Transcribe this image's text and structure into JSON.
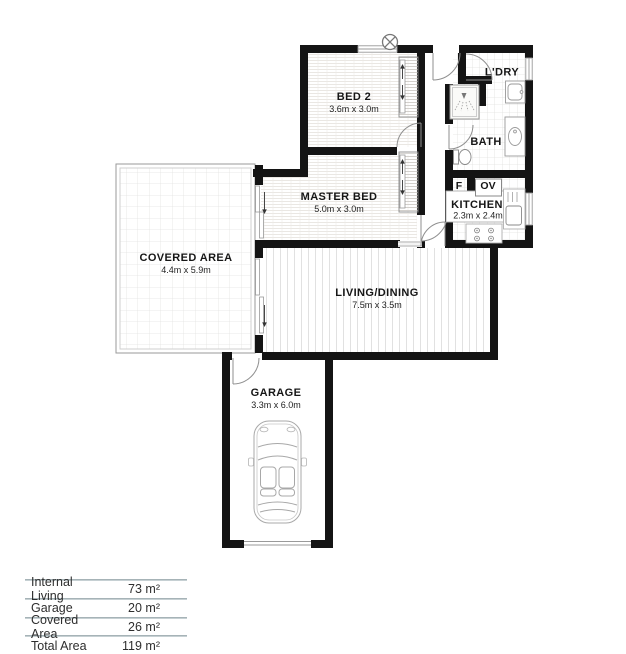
{
  "plan": {
    "rooms": {
      "bed2": {
        "name": "BED 2",
        "dims": "3.6m x 3.0m"
      },
      "master": {
        "name": "MASTER BED",
        "dims": "5.0m x 3.0m"
      },
      "laundry": {
        "name": "L'DRY"
      },
      "bath": {
        "name": "BATH"
      },
      "kitchen": {
        "name": "KITCHEN",
        "dims": "2.3m x 2.4m"
      },
      "covered": {
        "name": "COVERED AREA",
        "dims": "4.4m x 5.9m"
      },
      "living": {
        "name": "LIVING/DINING",
        "dims": "7.5m x 3.5m"
      },
      "garage": {
        "name": "GARAGE",
        "dims": "3.3m x 6.0m"
      }
    },
    "appliances": {
      "fridge": "F",
      "oven": "OV"
    },
    "colors": {
      "wall": "#141414",
      "fixture": "#999999",
      "table_line": "#96a4a9"
    }
  },
  "area_table": {
    "rows": [
      {
        "label": "Internal Living",
        "value": "73 m²"
      },
      {
        "label": "Garage",
        "value": "20 m²"
      },
      {
        "label": "Covered Area",
        "value": "26 m²"
      },
      {
        "label": "Total Area",
        "value": "119 m²"
      }
    ]
  }
}
